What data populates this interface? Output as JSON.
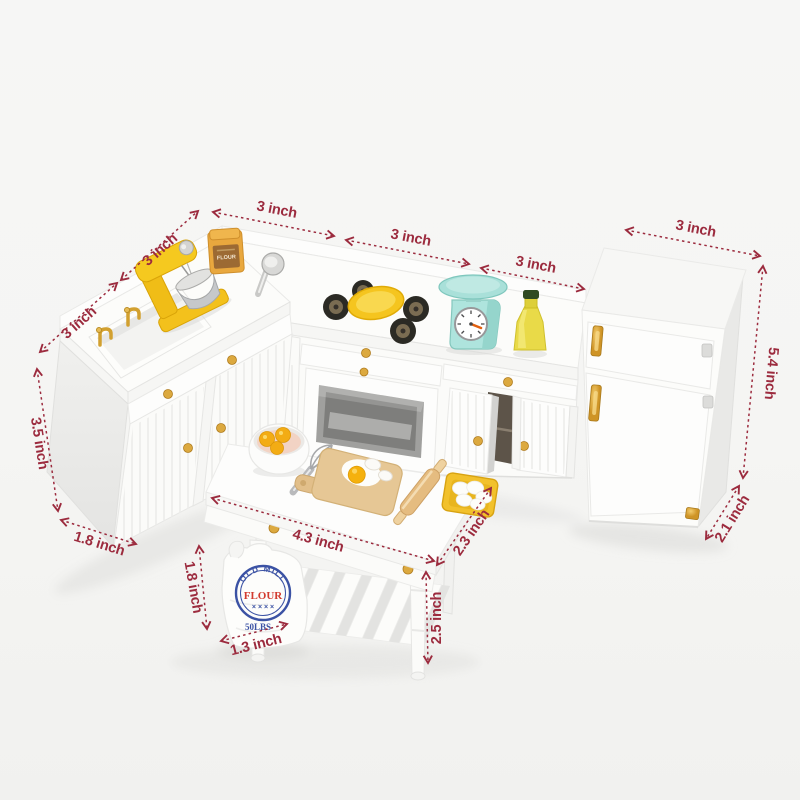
{
  "image": {
    "kind": "product-dimension-photo",
    "subject": "white dollhouse miniature kitchen furniture set with baking accessories"
  },
  "colors": {
    "accent": "#9c2b3e",
    "gold": "#dca93f",
    "mint": "#a9e0d9",
    "yellow": "#f3c11c",
    "wood": "#e6c795",
    "bag-blue": "#3b52a4",
    "bag-red": "#d23b2f"
  },
  "dims": {
    "sink_edge_left": "3 inch",
    "sink_edge_upper": "3 inch",
    "counter_section_1": "3 inch",
    "counter_section_2": "3 inch",
    "counter_section_3": "3 inch",
    "fridge_width": "3 inch",
    "fridge_height": "5.4 inch",
    "fridge_depth": "2.1 inch",
    "sink_cabinet_height": "3.5 inch",
    "sink_cabinet_depth": "1.8 inch",
    "island_width": "4.3 inch",
    "island_depth": "2.3 inch",
    "island_height": "2.5 inch",
    "flour_bag_height": "1.8 inch",
    "flour_bag_width": "1.3 inch"
  },
  "flour_bag": {
    "brand": "OLD MILL",
    "name": "FLOUR",
    "stars": "× × × ×",
    "weight": "50LBS"
  },
  "flour_jar": {
    "label": "FLOUR"
  }
}
